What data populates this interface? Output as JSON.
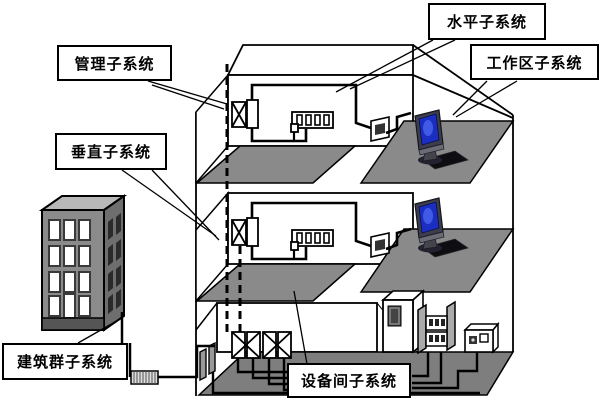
{
  "diagram": {
    "type": "structured-cabling-system-diagram",
    "labels": {
      "management": "管理子系统",
      "horizontal": "水平子系统",
      "work_area": "工作区子系统",
      "vertical": "垂直子系统",
      "campus": "建筑群子系统",
      "equipment_room": "设备间子系统"
    },
    "colors": {
      "outline": "#000000",
      "floor_gray": "#8a8a8a",
      "floor_dark": "#7e7e7e",
      "campus_front": "#8b8b8b",
      "campus_side": "#6e6e6e",
      "campus_top": "#b8b8b8",
      "screen_blue": "#1a2ec2",
      "label_bg": "#ffffff"
    },
    "icons": {
      "computer": "crt-monitor-with-keyboard",
      "cross_connect": "box-with-x",
      "patch_panel": "strip-with-4-ports",
      "wall_outlet": "plate-with-dark-center",
      "server_cabinet": "cabinet-with-door",
      "distribution_rack": "rack-with-ports",
      "network_device": "small-box-with-indicators",
      "riser": "dashed-vertical-line",
      "conduit": "hatched-duct"
    }
  }
}
